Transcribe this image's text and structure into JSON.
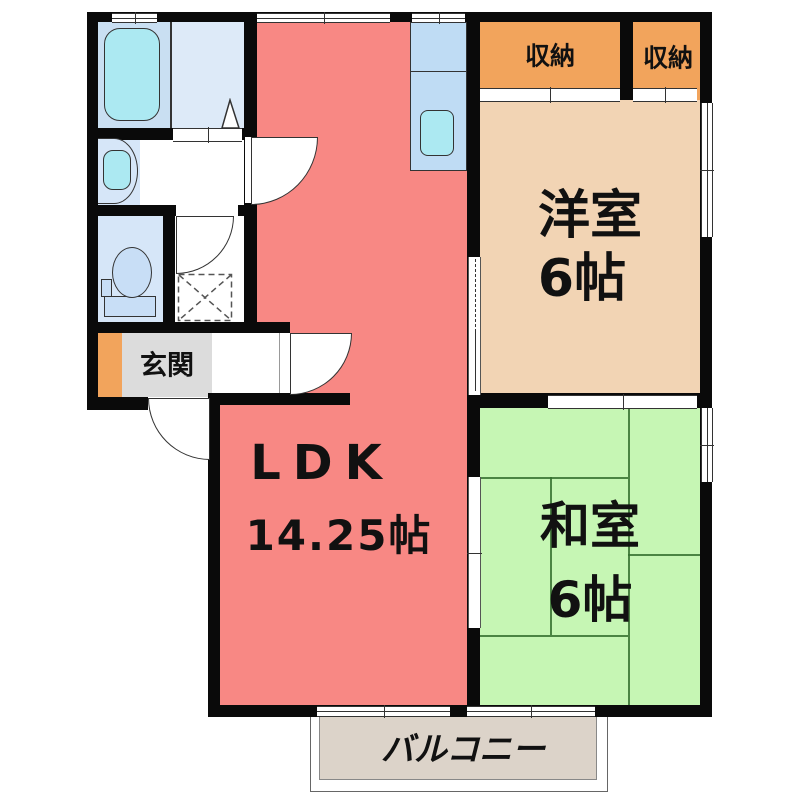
{
  "type": "apartment-floor-plan",
  "rooms": {
    "ldk": {
      "label": "LDK",
      "size": "14.25帖",
      "fill": "#F88884"
    },
    "western": {
      "label": "洋室",
      "size": "6帖",
      "fill": "#F2D4B4"
    },
    "japanese": {
      "label": "和室",
      "size": "6帖",
      "fill": "#C6F6B4"
    },
    "entrance": {
      "label": "玄関",
      "fill": "#DCDCDC",
      "accent": "#F2A45C"
    },
    "balcony": {
      "label": "バルコニー",
      "fill": "#DCD3C9"
    },
    "closet_left": {
      "label": "収納",
      "fill": "#F2A45C"
    },
    "closet_right": {
      "label": "収納",
      "fill": "#F2A45C"
    },
    "bathroom": {
      "fill": "#C9DFF2"
    },
    "washroom": {
      "fill": "#DDEAF8"
    },
    "toilet_room": {
      "fill": "#D6E6F8"
    },
    "kitchen_counter": {
      "fill": "#BFDCF4"
    }
  },
  "colors": {
    "wall": "#0A0A0A",
    "fixture_water": "#ACE9F2",
    "tatami_line": "#35702F"
  },
  "fixtures": [
    "bathtub",
    "washbasin",
    "toilet",
    "kitchen-sink",
    "floor-hatch",
    "door-swings",
    "sliding-doors",
    "windows"
  ]
}
